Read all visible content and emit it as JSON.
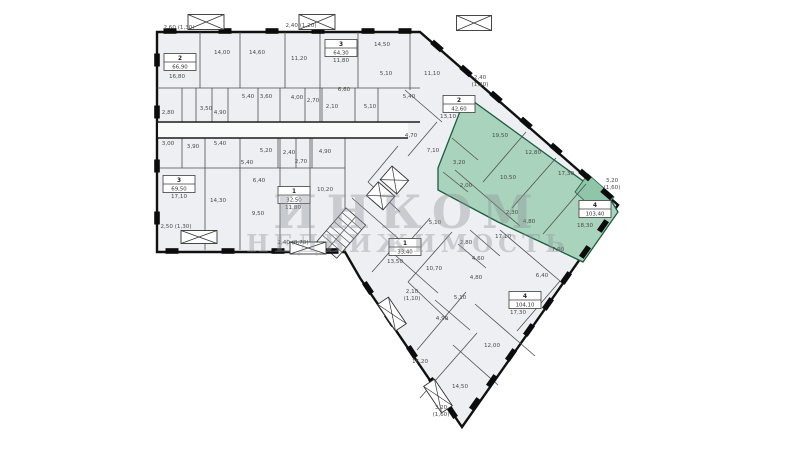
{
  "watermark": {
    "line1": "ИНКОМ",
    "line2": "НЕДВИЖИМОСТЬ"
  },
  "plan": {
    "highlight_color": "#a9d3bd",
    "highlight_balcony_color": "#8fc5a9",
    "floor_fill_color": "#edeff2",
    "wall_color": "#111111",
    "selected_apartment": {
      "number": "4",
      "total_area": "103,40"
    },
    "apartment_boxes": [
      {
        "number": "2",
        "area": "66,90",
        "x": 180,
        "y": 62,
        "highlighted": false
      },
      {
        "number": "3",
        "area": "64,30",
        "x": 341,
        "y": 48,
        "highlighted": false
      },
      {
        "number": "2",
        "area": "42,60",
        "x": 459,
        "y": 104,
        "highlighted": false
      },
      {
        "number": "4",
        "area": "103,40",
        "x": 595,
        "y": 209,
        "highlighted": true
      },
      {
        "number": "3",
        "area": "69,50",
        "x": 179,
        "y": 184,
        "highlighted": false
      },
      {
        "number": "1",
        "area": "32,50",
        "x": 294,
        "y": 195,
        "highlighted": false
      },
      {
        "number": "1",
        "area": "33,40",
        "x": 405,
        "y": 247,
        "highlighted": false
      },
      {
        "number": "4",
        "area": "104,10",
        "x": 525,
        "y": 300,
        "highlighted": false
      }
    ],
    "area_labels": [
      {
        "t": "2,60 (1,30)",
        "x": 179,
        "y": 29
      },
      {
        "t": "2,40 (1,20)",
        "x": 301,
        "y": 27
      },
      {
        "t": "16,80",
        "x": 177,
        "y": 78
      },
      {
        "t": "14,00",
        "x": 222,
        "y": 54
      },
      {
        "t": "14,60",
        "x": 257,
        "y": 54
      },
      {
        "t": "11,20",
        "x": 299,
        "y": 60
      },
      {
        "t": "11,80",
        "x": 341,
        "y": 62
      },
      {
        "t": "14,50",
        "x": 382,
        "y": 46
      },
      {
        "t": "5,40",
        "x": 248,
        "y": 98
      },
      {
        "t": "3,60",
        "x": 266,
        "y": 98
      },
      {
        "t": "4,00",
        "x": 297,
        "y": 99
      },
      {
        "t": "2,70",
        "x": 313,
        "y": 102
      },
      {
        "t": "6,60",
        "x": 344,
        "y": 91
      },
      {
        "t": "2,10",
        "x": 332,
        "y": 108
      },
      {
        "t": "5,10",
        "x": 386,
        "y": 75
      },
      {
        "t": "5,10",
        "x": 370,
        "y": 108
      },
      {
        "t": "2,80",
        "x": 168,
        "y": 114
      },
      {
        "t": "3,50",
        "x": 206,
        "y": 110
      },
      {
        "t": "4,90",
        "x": 220,
        "y": 114
      },
      {
        "t": "3,00",
        "x": 168,
        "y": 145
      },
      {
        "t": "3,90",
        "x": 193,
        "y": 148
      },
      {
        "t": "5,40",
        "x": 220,
        "y": 145
      },
      {
        "t": "5,20",
        "x": 266,
        "y": 152
      },
      {
        "t": "2,40",
        "x": 289,
        "y": 154
      },
      {
        "t": "4,90",
        "x": 325,
        "y": 153
      },
      {
        "t": "2,70",
        "x": 301,
        "y": 163
      },
      {
        "t": "5,40",
        "x": 247,
        "y": 164
      },
      {
        "t": "6,40",
        "x": 259,
        "y": 182
      },
      {
        "t": "17,10",
        "x": 179,
        "y": 198
      },
      {
        "t": "14,30",
        "x": 218,
        "y": 202
      },
      {
        "t": "9,50",
        "x": 258,
        "y": 215
      },
      {
        "t": "11,80",
        "x": 293,
        "y": 209
      },
      {
        "t": "10,20",
        "x": 325,
        "y": 191
      },
      {
        "t": "2,50 (1,30)",
        "x": 176,
        "y": 228
      },
      {
        "t": "2,40 (0,70)",
        "x": 293,
        "y": 244
      },
      {
        "t": "11,10",
        "x": 432,
        "y": 75
      },
      {
        "t": "5,40",
        "x": 409,
        "y": 98
      },
      {
        "t": "13,10",
        "x": 448,
        "y": 118
      },
      {
        "t": "4,70",
        "x": 411,
        "y": 137
      },
      {
        "t": "7,10",
        "x": 433,
        "y": 152
      },
      {
        "t": "2,40",
        "x": 480,
        "y": 79
      },
      {
        "t": "(1,20)",
        "x": 480,
        "y": 86
      },
      {
        "t": "19,50",
        "x": 500,
        "y": 137
      },
      {
        "t": "12,80",
        "x": 533,
        "y": 154
      },
      {
        "t": "17,30",
        "x": 566,
        "y": 175
      },
      {
        "t": "3,20",
        "x": 459,
        "y": 164
      },
      {
        "t": "2,00",
        "x": 466,
        "y": 187
      },
      {
        "t": "10,50",
        "x": 508,
        "y": 179
      },
      {
        "t": "2,30",
        "x": 512,
        "y": 214
      },
      {
        "t": "4,80",
        "x": 529,
        "y": 223
      },
      {
        "t": "7,90",
        "x": 558,
        "y": 251
      },
      {
        "t": "18,30",
        "x": 585,
        "y": 227
      },
      {
        "t": "3,20",
        "x": 612,
        "y": 182
      },
      {
        "t": "(1,60)",
        "x": 612,
        "y": 189
      },
      {
        "t": "5,10",
        "x": 435,
        "y": 224
      },
      {
        "t": "2,80",
        "x": 466,
        "y": 244
      },
      {
        "t": "4,60",
        "x": 478,
        "y": 260
      },
      {
        "t": "4,80",
        "x": 476,
        "y": 279
      },
      {
        "t": "5,10",
        "x": 460,
        "y": 299
      },
      {
        "t": "13,50",
        "x": 395,
        "y": 263
      },
      {
        "t": "10,70",
        "x": 434,
        "y": 270
      },
      {
        "t": "2,10",
        "x": 412,
        "y": 293
      },
      {
        "t": "(1,10)",
        "x": 412,
        "y": 300
      },
      {
        "t": "4,90",
        "x": 442,
        "y": 320
      },
      {
        "t": "17,10",
        "x": 503,
        "y": 238
      },
      {
        "t": "6,40",
        "x": 542,
        "y": 277
      },
      {
        "t": "17,30",
        "x": 518,
        "y": 314
      },
      {
        "t": "12,00",
        "x": 492,
        "y": 347
      },
      {
        "t": "16,20",
        "x": 420,
        "y": 363
      },
      {
        "t": "14,50",
        "x": 460,
        "y": 388
      },
      {
        "t": "3,20",
        "x": 441,
        "y": 409
      },
      {
        "t": "(1,60)",
        "x": 441,
        "y": 416
      }
    ],
    "balcony_marks": [
      {
        "x": 206,
        "y": 22,
        "w": 36,
        "h": 15,
        "r": 0
      },
      {
        "x": 317,
        "y": 22,
        "w": 36,
        "h": 15,
        "r": 0
      },
      {
        "x": 474,
        "y": 23,
        "w": 35,
        "h": 15,
        "r": 0
      },
      {
        "x": 199,
        "y": 237,
        "w": 36,
        "h": 13,
        "r": 0
      },
      {
        "x": 308,
        "y": 248,
        "w": 36,
        "h": 12,
        "r": 0
      },
      {
        "x": 392,
        "y": 314,
        "w": 32,
        "h": 13,
        "r": 56
      },
      {
        "x": 438,
        "y": 396,
        "w": 32,
        "h": 13,
        "r": 56
      }
    ]
  }
}
